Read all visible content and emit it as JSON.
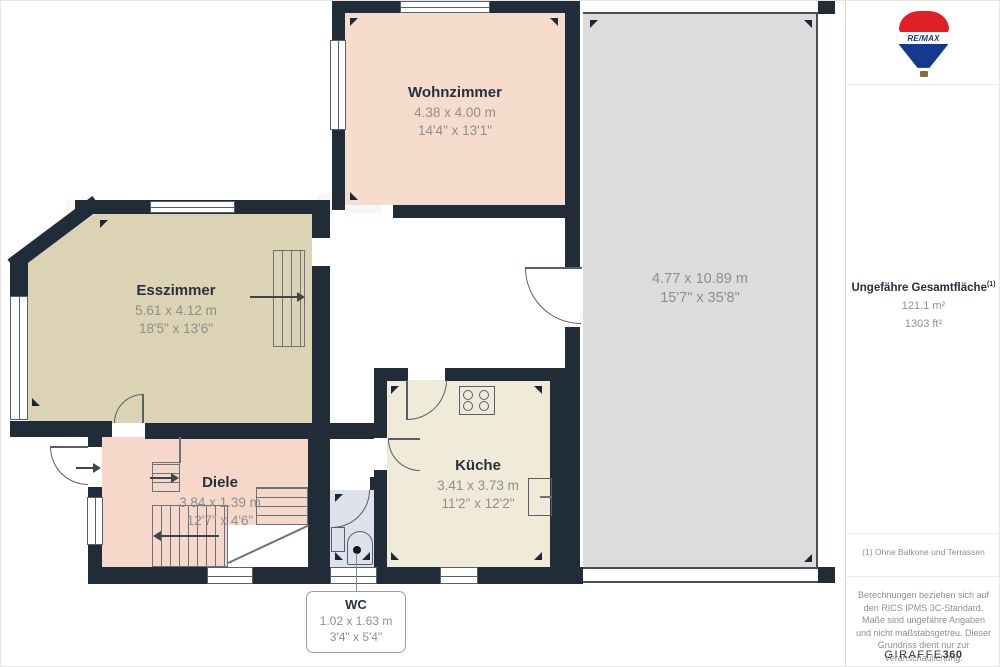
{
  "plan": {
    "watermark": "RE/MAX",
    "rooms": {
      "wohnzimmer": {
        "name": "Wohnzimmer",
        "metric": "4.38 x 4.00 m",
        "imperial": "14'4\" x 13'1\""
      },
      "esszimmer": {
        "name": "Esszimmer",
        "metric": "5.61 x 4.12 m",
        "imperial": "18'5\" x 13'6\""
      },
      "kueche": {
        "name": "Küche",
        "metric": "3.41 x 3.73 m",
        "imperial": "11'2\" x 12'2\""
      },
      "diele": {
        "name": "Diele",
        "metric": "3.84 x 1.39 m",
        "imperial": "12'7\" x 4'6\""
      },
      "terrasse": {
        "name": "",
        "metric": "4.77 x 10.89 m",
        "imperial": "15'7\" x 35'8\""
      },
      "wc": {
        "name": "WC",
        "metric": "1.02 x 1.63 m",
        "imperial": "3'4\" x 5'4\""
      }
    }
  },
  "sidebar": {
    "brand": "RE/MAX",
    "total_area_label": "Ungefähre Gesamtfläche",
    "total_area_superscript": "(1)",
    "total_area_m2": "121.1 m²",
    "total_area_ft2": "1303 ft²",
    "footnote": "(1) Ohne Balkone und Terrassen",
    "disclaimer": "Berechnungen beziehen sich auf den RICS IPMS 3C-Standard. Maße sind ungefähre Angaben und nicht maßstabsgetreu. Dieser Grundriss dient nur zur Veranschaulichung.",
    "provider": "GIRAFFE",
    "provider_suffix": "360"
  },
  "colors": {
    "wall": "#212c39",
    "room_living": "#f5dccd",
    "room_dining": "#dcd2b4",
    "room_kitchen": "#f0ebd8",
    "room_wc": "#dde2ed",
    "terrace": "#dcdcdc",
    "brand_red": "#e01f26",
    "brand_blue": "#16388e"
  }
}
